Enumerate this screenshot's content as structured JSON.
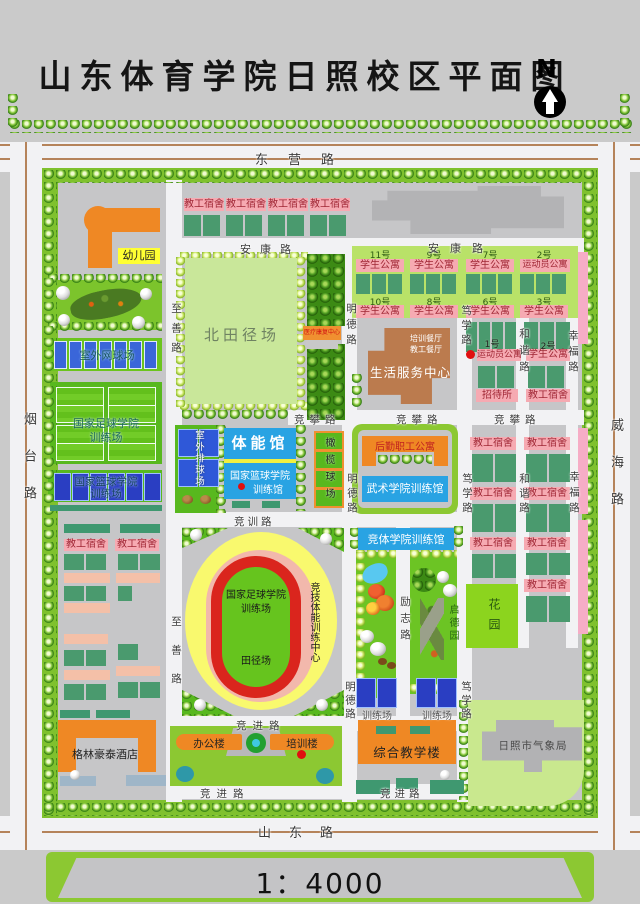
{
  "title": "山东体育学院日照校区平面图",
  "compass": "N",
  "scale_text": "1：4000",
  "roads": {
    "dongying": "东营路",
    "shandong": "山东路",
    "yantai": "烟台路",
    "weihai": "威海路",
    "ankang": "安康路",
    "zhishan": "至善路",
    "mingde": "明德路",
    "duxue": "笃学路",
    "hexie": "和谐路",
    "xingfu": "幸福路",
    "jingpan": "竞攀路",
    "jingxun": "竞训路",
    "jingjin": "竞进路",
    "lizhi": "励志路"
  },
  "labels": {
    "faculty_dorm": "教工宿舍",
    "student_apartment": "学生公寓",
    "athlete_apartment": "运动员公寓",
    "kindergarten": "幼儿园",
    "north_track_field": "北田径场",
    "medical_center": "医疗康复中心",
    "training_canteen": "培训餐厅",
    "staff_canteen": "教工餐厅",
    "life_service_center": "生活服务中心",
    "guesthouse": "招待所",
    "outdoor_tennis": "室外网球场",
    "outdoor_volleyball": "室外排球场",
    "football_academy": "国家足球学院",
    "basketball_academy": "国家篮球学院",
    "training_field": "训练场",
    "training_hall": "训练馆",
    "physical_hall": "体能馆",
    "rugby_field": "橄榄球场",
    "logistics_apartment": "后勤职工公寓",
    "wushu_hall": "武术学院训练馆",
    "jingti_hall": "竞体学院训练馆",
    "garden": "花园",
    "qide_garden": "启德园",
    "track_field": "田径场",
    "competitive_center": "竞技体能训练中心",
    "office_building": "办公楼",
    "training_building": "培训楼",
    "hotel": "格林豪泰酒店",
    "teaching_building": "综合教学楼",
    "meteorological": "日照市气象局"
  },
  "numbers": {
    "n11": "11号",
    "n10": "10号",
    "n9": "9号",
    "n8": "8号",
    "n7": "7号",
    "n6": "6号",
    "n3": "3号",
    "n2": "2号",
    "n1": "1号"
  }
}
